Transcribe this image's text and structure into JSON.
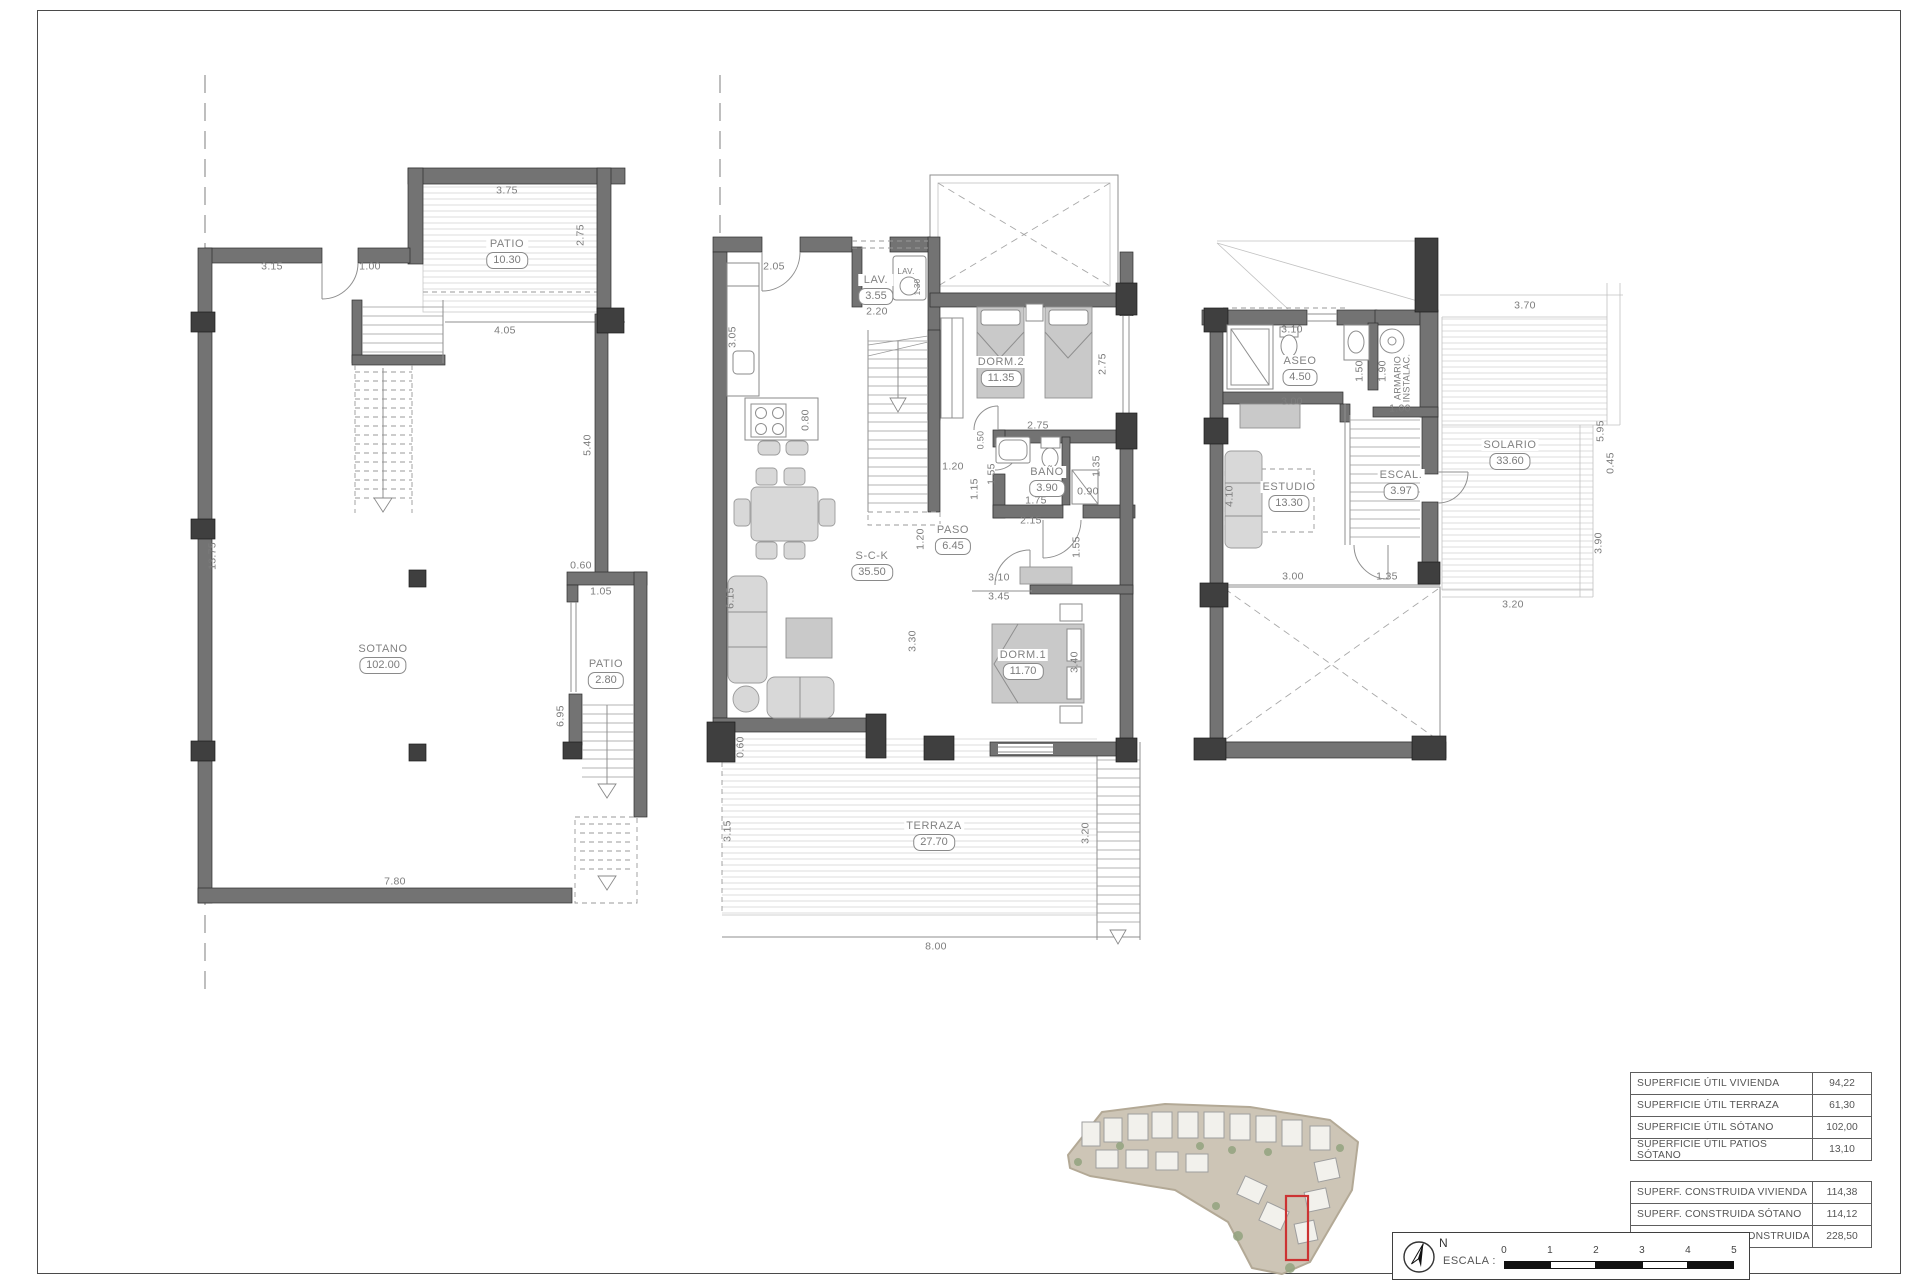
{
  "colors": {
    "wall": "#737373",
    "accent_red": "#c9342c",
    "hatch_line": "#dcdcdc"
  },
  "annotations": {
    "rooms": [
      {
        "plan": "sotano",
        "name": "PATIO",
        "area": "10.30",
        "x": 507,
        "y": 238
      },
      {
        "plan": "sotano",
        "name": "SOTANO",
        "area": "102.00",
        "x": 383,
        "y": 643
      },
      {
        "plan": "sotano",
        "name": "PATIO",
        "area": "2.80",
        "x": 606,
        "y": 658
      },
      {
        "plan": "baja",
        "name": "LAV.",
        "area": "3.55",
        "x": 876,
        "y": 274
      },
      {
        "plan": "baja",
        "name": "DORM.2",
        "area": "11.35",
        "x": 1001,
        "y": 356
      },
      {
        "plan": "baja",
        "name": "BAÑO",
        "area": "3.90",
        "x": 1047,
        "y": 466
      },
      {
        "plan": "baja",
        "name": "PASO",
        "area": "6.45",
        "x": 953,
        "y": 524
      },
      {
        "plan": "baja",
        "name": "S-C-K",
        "area": "35.50",
        "x": 872,
        "y": 550
      },
      {
        "plan": "baja",
        "name": "DORM.1",
        "area": "11.70",
        "x": 1023,
        "y": 649
      },
      {
        "plan": "baja",
        "name": "TERRAZA",
        "area": "27.70",
        "x": 934,
        "y": 820
      },
      {
        "plan": "alta",
        "name": "ASEO",
        "area": "4.50",
        "x": 1300,
        "y": 355
      },
      {
        "plan": "alta",
        "name": "ESTUDIO",
        "area": "13.30",
        "x": 1289,
        "y": 481
      },
      {
        "plan": "alta",
        "name": "ESCAL.",
        "area": "3.97",
        "x": 1401,
        "y": 469
      },
      {
        "plan": "alta",
        "name": "SOLARIO",
        "area": "33.60",
        "x": 1510,
        "y": 439
      }
    ],
    "dims": [
      {
        "t": "3.75",
        "x": 507,
        "y": 191
      },
      {
        "t": "3.15",
        "x": 272,
        "y": 267
      },
      {
        "t": "1.00",
        "x": 370,
        "y": 267
      },
      {
        "t": "2.75",
        "x": 581,
        "y": 235,
        "r": -90
      },
      {
        "t": "4.05",
        "x": 505,
        "y": 331
      },
      {
        "t": "13.75",
        "x": 213,
        "y": 556,
        "r": -90
      },
      {
        "t": "5.40",
        "x": 588,
        "y": 445,
        "r": -90
      },
      {
        "t": "0.60",
        "x": 581,
        "y": 566
      },
      {
        "t": "1.05",
        "x": 601,
        "y": 592
      },
      {
        "t": "6.95",
        "x": 561,
        "y": 716,
        "r": -90
      },
      {
        "t": "7.80",
        "x": 395,
        "y": 882
      },
      {
        "t": "2.05",
        "x": 774,
        "y": 267
      },
      {
        "t": "3.05",
        "x": 733,
        "y": 337,
        "r": -90
      },
      {
        "t": "LAV.",
        "x": 906,
        "y": 272,
        "s": 8
      },
      {
        "t": "1.30",
        "x": 918,
        "y": 287,
        "r": -90,
        "s": 8
      },
      {
        "t": "2.20",
        "x": 877,
        "y": 312
      },
      {
        "t": "0.80",
        "x": 806,
        "y": 420,
        "r": -90
      },
      {
        "t": "2.75",
        "x": 1103,
        "y": 364,
        "r": -90
      },
      {
        "t": "2.75",
        "x": 1038,
        "y": 426
      },
      {
        "t": "0.50",
        "x": 981,
        "y": 440,
        "r": -90,
        "s": 9
      },
      {
        "t": "1.55",
        "x": 992,
        "y": 474,
        "r": -90
      },
      {
        "t": "1.15",
        "x": 975,
        "y": 489,
        "r": -90
      },
      {
        "t": "0.90",
        "x": 1088,
        "y": 492
      },
      {
        "t": "1.35",
        "x": 1097,
        "y": 466,
        "r": -90
      },
      {
        "t": "1.75",
        "x": 1036,
        "y": 501
      },
      {
        "t": "2.15",
        "x": 1031,
        "y": 521
      },
      {
        "t": "1.55",
        "x": 1077,
        "y": 547,
        "r": -90
      },
      {
        "t": "1.20",
        "x": 953,
        "y": 467
      },
      {
        "t": "1.20",
        "x": 921,
        "y": 539,
        "r": -90
      },
      {
        "t": "3.10",
        "x": 999,
        "y": 578
      },
      {
        "t": "3.45",
        "x": 999,
        "y": 597
      },
      {
        "t": "3.30",
        "x": 913,
        "y": 641,
        "r": -90
      },
      {
        "t": "3.40",
        "x": 1075,
        "y": 662,
        "r": -90
      },
      {
        "t": "6.15",
        "x": 731,
        "y": 598,
        "r": -90
      },
      {
        "t": "0.60",
        "x": 741,
        "y": 747,
        "r": -90
      },
      {
        "t": "3.15",
        "x": 728,
        "y": 831,
        "r": -90
      },
      {
        "t": "3.20",
        "x": 1086,
        "y": 833,
        "r": -90
      },
      {
        "t": "8.00",
        "x": 936,
        "y": 947
      },
      {
        "t": "3.10",
        "x": 1292,
        "y": 330
      },
      {
        "t": "1.50",
        "x": 1360,
        "y": 371,
        "r": -90
      },
      {
        "t": "1.90",
        "x": 1383,
        "y": 371,
        "r": -90
      },
      {
        "t": "ARMARIO\nINSTALAC.",
        "x": 1403,
        "y": 378,
        "r": -90,
        "s": 9
      },
      {
        "t": "1.00",
        "x": 1400,
        "y": 409
      },
      {
        "t": "3.00",
        "x": 1292,
        "y": 402
      },
      {
        "t": "4.10",
        "x": 1230,
        "y": 496,
        "r": -90
      },
      {
        "t": "3.70",
        "x": 1525,
        "y": 306
      },
      {
        "t": "5.95",
        "x": 1601,
        "y": 431,
        "r": -90
      },
      {
        "t": "3.00",
        "x": 1293,
        "y": 577
      },
      {
        "t": "1.35",
        "x": 1387,
        "y": 577
      },
      {
        "t": "0.45",
        "x": 1611,
        "y": 463,
        "r": -90
      },
      {
        "t": "3.90",
        "x": 1599,
        "y": 543,
        "r": -90
      },
      {
        "t": "3.20",
        "x": 1513,
        "y": 605
      }
    ]
  },
  "tables": {
    "util": {
      "rows": [
        {
          "label": "SUPERFICIE ÚTIL VIVIENDA",
          "value": "94,22"
        },
        {
          "label": "SUPERFICIE ÚTIL TERRAZA",
          "value": "61,30"
        },
        {
          "label": "SUPERFICIE ÚTIL SÓTANO",
          "value": "102,00"
        },
        {
          "label": "SUPERFICIE ÚTIL PATIOS SÓTANO",
          "value": "13,10"
        }
      ]
    },
    "construida": {
      "rows": [
        {
          "label": "SUPERF. CONSTRUIDA VIVIENDA",
          "value": "114,38"
        },
        {
          "label": "SUPERF. CONSTRUIDA SÓTANO",
          "value": "114,12"
        },
        {
          "label": "TOTAL SUPERFICIE CONSTRUIDA",
          "value": "228,50"
        }
      ]
    }
  },
  "scale_bar": {
    "label": "ESCALA :",
    "north": "N",
    "ticks": [
      "0",
      "1",
      "2",
      "3",
      "4",
      "5"
    ]
  }
}
